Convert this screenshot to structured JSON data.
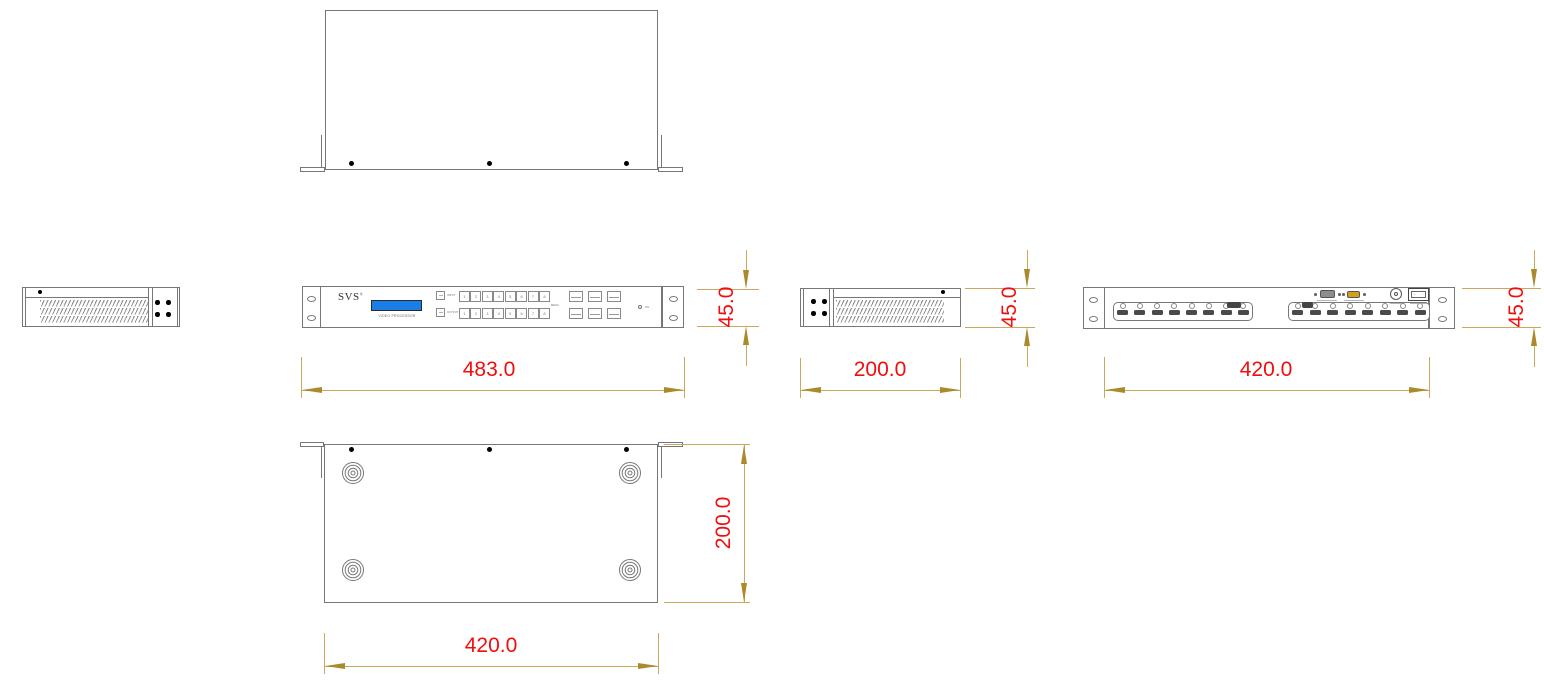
{
  "colors": {
    "red": "#f20d0d",
    "line": "#c9a95c",
    "arrow": "#ab8a2c",
    "ink": "#777777",
    "blue": "#1a7ee6"
  },
  "front_panel": {
    "brand": "SVS",
    "brand_mark": "®",
    "display_label": "VIDEO PROCESSOR",
    "row1_label": "INPUT",
    "row2_label": "OUTPUT",
    "menu_label": "MENU",
    "power_label": "ON",
    "input_buttons": [
      "1",
      "2",
      "3",
      "4",
      "5",
      "6",
      "7",
      "8"
    ],
    "output_buttons": [
      "1",
      "2",
      "3",
      "4",
      "5",
      "6",
      "7",
      "8"
    ]
  },
  "rear_panel": {
    "power_switch_on": "—",
    "power_switch_off": "○"
  },
  "dimensions": {
    "front_width": "483.0",
    "height": "45.0",
    "side_depth": "200.0",
    "rear_width": "420.0",
    "bottom_depth": "200.0",
    "bottom_width": "420.0"
  }
}
